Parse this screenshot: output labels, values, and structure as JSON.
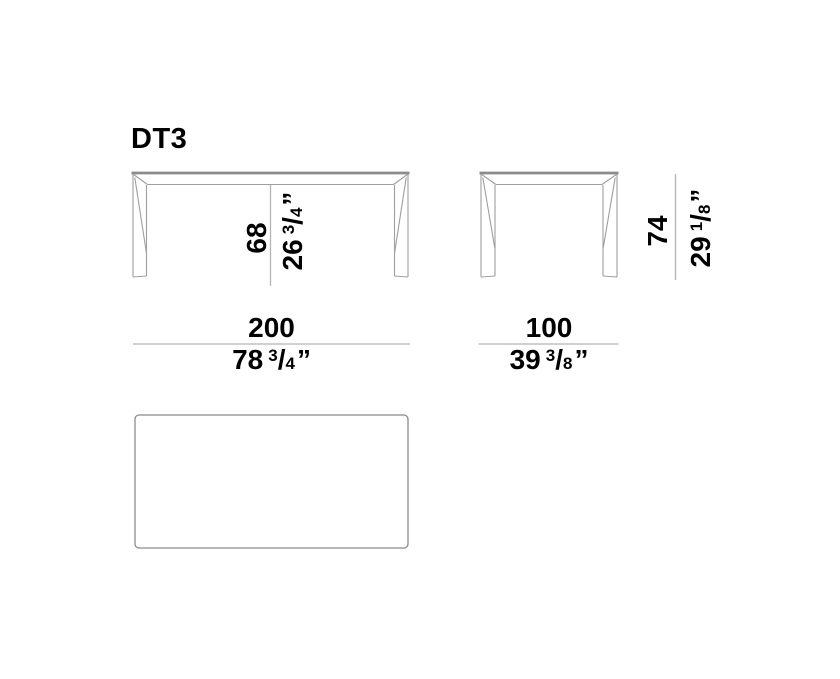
{
  "title": "DT3",
  "colors": {
    "background": "#ffffff",
    "text": "#000000",
    "edge": "#8b8b8b",
    "outline": "#9f9f9f",
    "dim": "#b3b3b3"
  },
  "dimensions": {
    "width": {
      "cm": "200",
      "inches": {
        "whole": "78",
        "numerator": "3",
        "slash": "/",
        "denominator": "4",
        "unit": "”"
      }
    },
    "depth": {
      "cm": "100",
      "inches": {
        "whole": "39",
        "numerator": "3",
        "slash": "/",
        "denominator": "8",
        "unit": "”"
      }
    },
    "table_height": {
      "cm": "74",
      "inches": {
        "whole": "29",
        "numerator": "1",
        "slash": "/",
        "denominator": "8",
        "unit": "”"
      }
    },
    "underside_clearance": {
      "cm": "68",
      "inches": {
        "whole": "26",
        "numerator": "3",
        "slash": "/",
        "denominator": "4",
        "unit": "”"
      }
    }
  }
}
